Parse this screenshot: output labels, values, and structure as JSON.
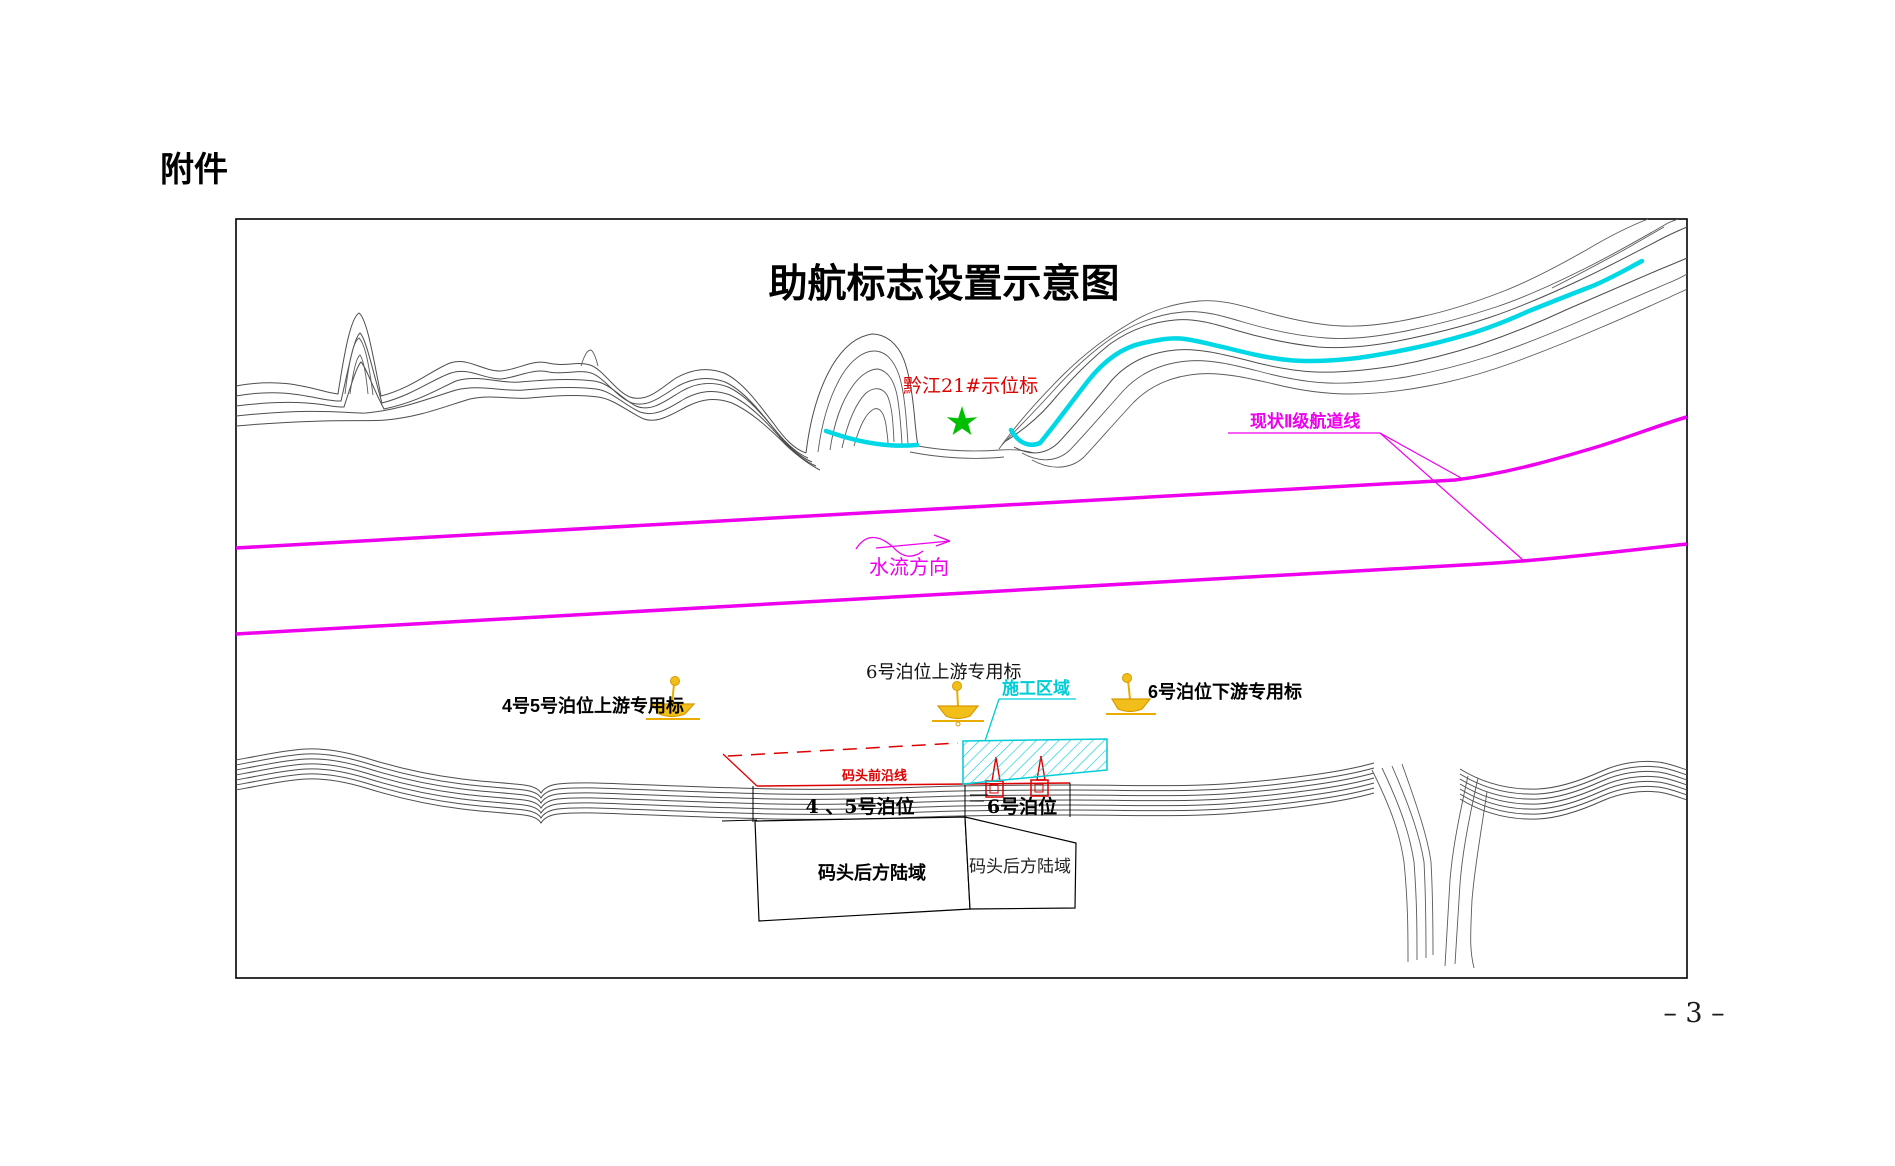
{
  "page": {
    "attachment_label": "附件",
    "page_number": "– 3 –"
  },
  "diagram": {
    "title": "助航标志设置示意图",
    "labels": {
      "station_mark": "黔江21#示位标",
      "channel_line": "现状Ⅱ级航道线",
      "flow_direction": "水流方向",
      "buoy_upstream_45": "4号5号泊位上游专用标",
      "buoy_upstream_6": "6号泊位上游专用标",
      "buoy_downstream_6": "6号泊位下游专用标",
      "construction_area": "施工区域",
      "wharf_front_line": "码头前沿线",
      "berth_45": "4 、5号泊位",
      "berth_6": "6号泊位",
      "land_left": "码头后方陆域",
      "land_right": "码头后方陆域"
    },
    "colors": {
      "channel_magenta": "#EE00EE",
      "river_cyan": "#00D8E6",
      "construction_cyan": "#00CCD6",
      "marker_red": "#DD0000",
      "buoy_yellow": "#F2BE19",
      "buoy_outline": "#D89A00",
      "star_green": "#00BF00",
      "contour_gray": "#4D4D4D"
    }
  }
}
